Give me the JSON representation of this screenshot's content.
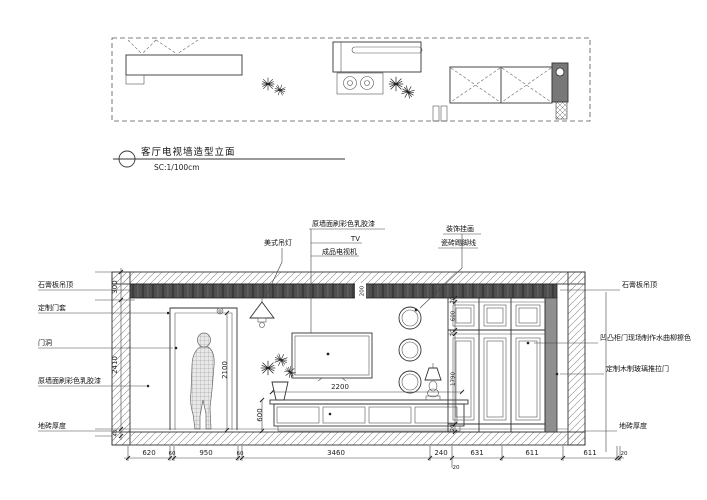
{
  "drawing": {
    "title": "客厅电视墙造型立面",
    "scale": "SC:1/100cm"
  },
  "callouts": {
    "top": {
      "pendant": "美式吊灯",
      "wall_paint": "原墙面刷彩色乳胶漆",
      "tv": "TV",
      "tv_set": "成品电视机",
      "art": "装饰挂画",
      "skirting": "瓷砖踢脚线"
    },
    "left": {
      "ceiling": "石膏板吊顶",
      "door_frame": "定制门套",
      "door_opening": "门洞",
      "wall_paint": "原墙面刷彩色乳胶漆",
      "tile": "地砖厚度"
    },
    "right": {
      "ceiling": "石膏板吊顶",
      "cabinet_door": "凹凸柜门现场制作水曲柳擦色",
      "sliding_door": "定制木制玻璃推拉门",
      "tile": "地砖厚度"
    }
  },
  "dims": {
    "left_col": [
      "300",
      "2410",
      "40"
    ],
    "band": "200",
    "door_height": "2100",
    "tv_cabinet_width": "2200",
    "tv_cabinet_height": "600",
    "right_col": [
      "20",
      "600",
      "20",
      "1790",
      "20"
    ],
    "bottom": [
      "620",
      "60",
      "950",
      "60",
      "3460",
      "240",
      "631",
      "611",
      "611",
      "20"
    ],
    "bottom_sub": "20"
  },
  "colors": {
    "band": "#4f4f4f",
    "column": "#787878",
    "cabinet_side": "#8f8f8f",
    "line": "#333333"
  }
}
